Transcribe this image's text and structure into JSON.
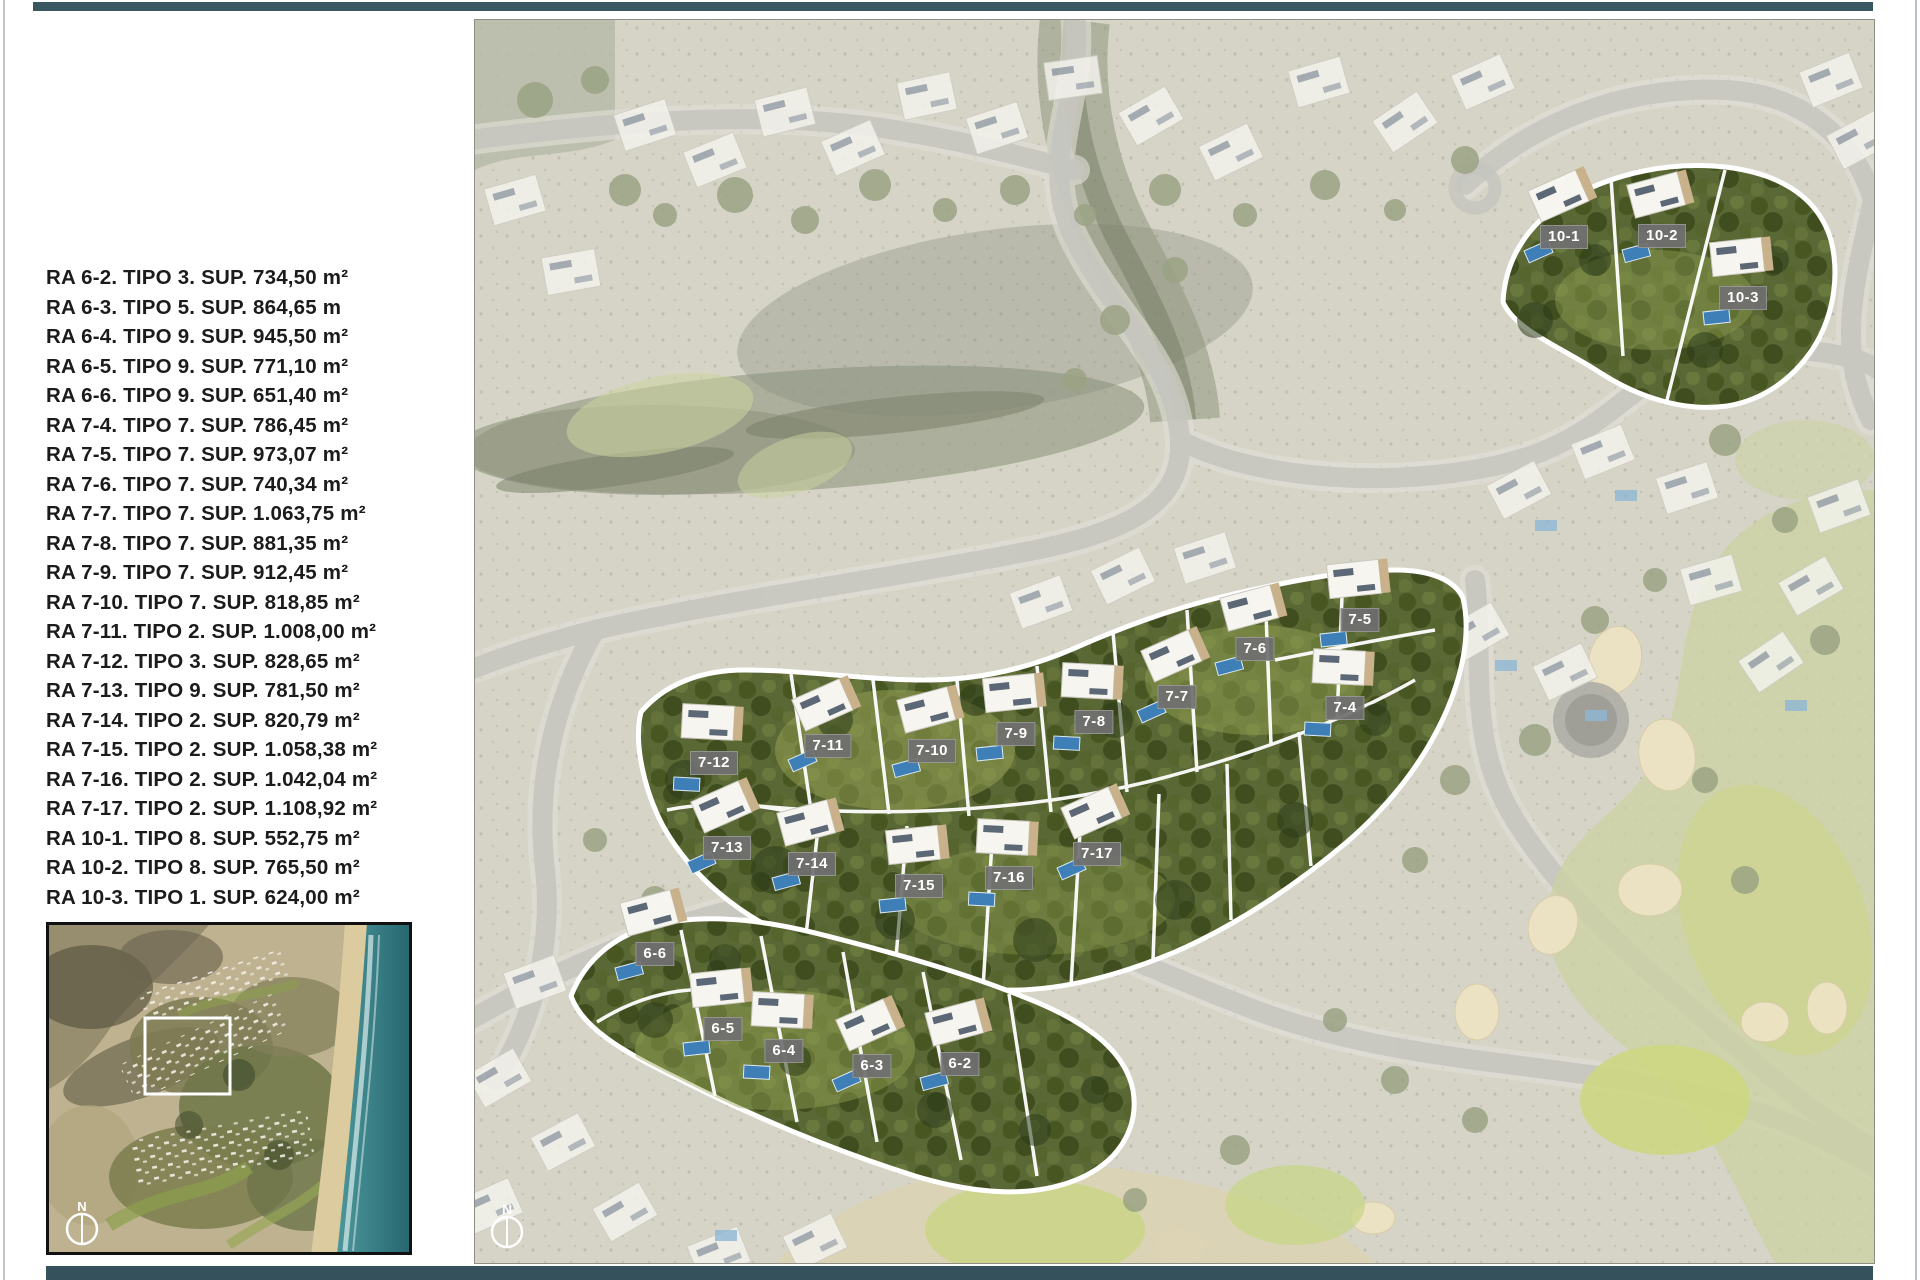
{
  "page": {
    "bg": "#ffffff",
    "frame_color": "#3a5660"
  },
  "plot_list": {
    "items": [
      "RA 6-2. TIPO 3. SUP. 734,50 m²",
      "RA 6-3. TIPO 5. SUP. 864,65 m",
      "RA 6-4. TIPO 9. SUP. 945,50 m²",
      "RA 6-5. TIPO 9. SUP. 771,10 m²",
      "RA 6-6. TIPO 9. SUP. 651,40 m²",
      "RA 7-4. TIPO 7. SUP. 786,45 m²",
      "RA 7-5. TIPO 7. SUP. 973,07 m²",
      "RA 7-6. TIPO 7. SUP. 740,34 m²",
      "RA 7-7. TIPO 7. SUP. 1.063,75 m²",
      "RA 7-8. TIPO 7. SUP. 881,35 m²",
      "RA 7-9. TIPO 7. SUP. 912,45 m²",
      "RA 7-10. TIPO 7. SUP. 818,85 m²",
      "RA 7-11. TIPO 2. SUP. 1.008,00 m²",
      "RA 7-12. TIPO 3. SUP. 828,65 m²",
      "RA 7-13. TIPO 9. SUP. 781,50 m²",
      "RA 7-14. TIPO 2. SUP. 820,79 m²",
      "RA 7-15. TIPO 2. SUP. 1.058,38 m²",
      "RA 7-16. TIPO 2. SUP. 1.042,04 m²",
      "RA 7-17. TIPO 2. SUP. 1.108,92 m²",
      "RA 10-1. TIPO 8. SUP. 552,75 m²",
      "RA 10-2. TIPO 8. SUP. 765,50 m²",
      "RA 10-3. TIPO 1. SUP. 624,00 m²"
    ]
  },
  "minimap": {
    "compass_label": "N"
  },
  "main_map": {
    "compass_label": "N",
    "label_bg": "#707070",
    "label_text_color": "#ffffff",
    "plot_labels": [
      {
        "id": "10-1",
        "x": 1089,
        "y": 217
      },
      {
        "id": "10-2",
        "x": 1187,
        "y": 216
      },
      {
        "id": "10-3",
        "x": 1268,
        "y": 278
      },
      {
        "id": "7-12",
        "x": 239,
        "y": 743
      },
      {
        "id": "7-11",
        "x": 353,
        "y": 726
      },
      {
        "id": "7-10",
        "x": 457,
        "y": 731
      },
      {
        "id": "7-9",
        "x": 541,
        "y": 714
      },
      {
        "id": "7-8",
        "x": 619,
        "y": 702
      },
      {
        "id": "7-7",
        "x": 702,
        "y": 677
      },
      {
        "id": "7-6",
        "x": 780,
        "y": 629
      },
      {
        "id": "7-5",
        "x": 885,
        "y": 600
      },
      {
        "id": "7-4",
        "x": 870,
        "y": 688
      },
      {
        "id": "7-13",
        "x": 252,
        "y": 828
      },
      {
        "id": "7-14",
        "x": 337,
        "y": 844
      },
      {
        "id": "7-15",
        "x": 444,
        "y": 866
      },
      {
        "id": "7-16",
        "x": 534,
        "y": 858
      },
      {
        "id": "7-17",
        "x": 622,
        "y": 834
      },
      {
        "id": "6-6",
        "x": 180,
        "y": 934
      },
      {
        "id": "6-5",
        "x": 248,
        "y": 1009
      },
      {
        "id": "6-4",
        "x": 309,
        "y": 1031
      },
      {
        "id": "6-3",
        "x": 397,
        "y": 1046
      },
      {
        "id": "6-2",
        "x": 485,
        "y": 1044
      }
    ]
  }
}
